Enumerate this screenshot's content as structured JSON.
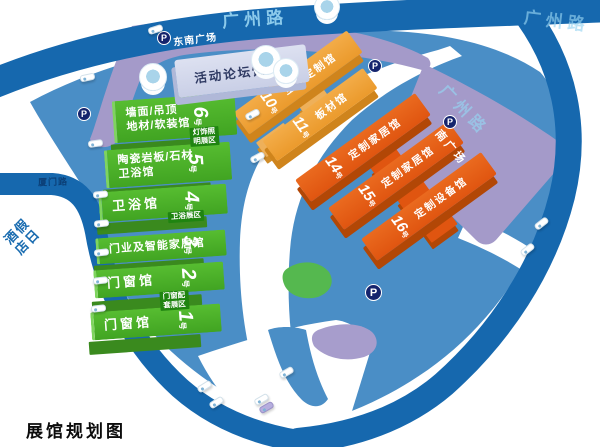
{
  "title": "展馆规划图",
  "roads": {
    "guangzhou": "广州路",
    "xiamen": "厦门路"
  },
  "landmarks": {
    "hotel": "假日酒店",
    "southeast_plaza": "东南广场",
    "south_plaza": "南广场",
    "parking": "P"
  },
  "forum_hall": {
    "name": "活动论坛馆",
    "number": "9",
    "unit": "号"
  },
  "green_halls": [
    {
      "id": "hall-6",
      "name_line1": "墙面/吊顶",
      "name_line2": "地材/软装馆",
      "number": "6",
      "unit": "号",
      "tag_line1": "灯饰照",
      "tag_line2": "明展区"
    },
    {
      "id": "hall-5",
      "name_line1": "陶瓷岩板/石材",
      "name_line2": "卫浴馆",
      "number": "5",
      "unit": "号"
    },
    {
      "id": "hall-4",
      "name_line1": "卫浴馆",
      "number": "4",
      "unit": "号",
      "tag_line1": "卫浴展区"
    },
    {
      "id": "hall-3",
      "name_line1": "门业及智能家居馆",
      "number": "3",
      "unit": "号"
    },
    {
      "id": "hall-2",
      "name_line1": "门窗馆",
      "number": "2",
      "unit": "号",
      "tag_line1": "门窗配",
      "tag_line2": "套展区"
    },
    {
      "id": "hall-1",
      "name_line1": "门窗馆",
      "number": "1",
      "unit": "号"
    }
  ],
  "orange_halls": [
    {
      "id": "hall-10",
      "name": "全屋定制馆",
      "number": "10",
      "unit": "号",
      "shade": "light"
    },
    {
      "id": "hall-11",
      "name": "板材馆",
      "number": "11",
      "unit": "号",
      "shade": "light"
    },
    {
      "id": "hall-14",
      "name": "定制家居馆",
      "number": "14",
      "unit": "号",
      "shade": "dark"
    },
    {
      "id": "hall-15",
      "name": "定制家居馆",
      "number": "15",
      "unit": "号",
      "shade": "dark"
    },
    {
      "id": "hall-16",
      "name": "定制设备馆",
      "number": "16",
      "unit": "号",
      "shade": "dark"
    }
  ],
  "colors": {
    "road_blue": "#1668ae",
    "site_blue": "#4a8ec6",
    "hall_green": "#4caf2c",
    "hall_orange_light": "#f0a33c",
    "hall_orange_dark": "#e55c15",
    "plaza_purple": "#a49ac9",
    "parking_navy": "#15246d"
  }
}
